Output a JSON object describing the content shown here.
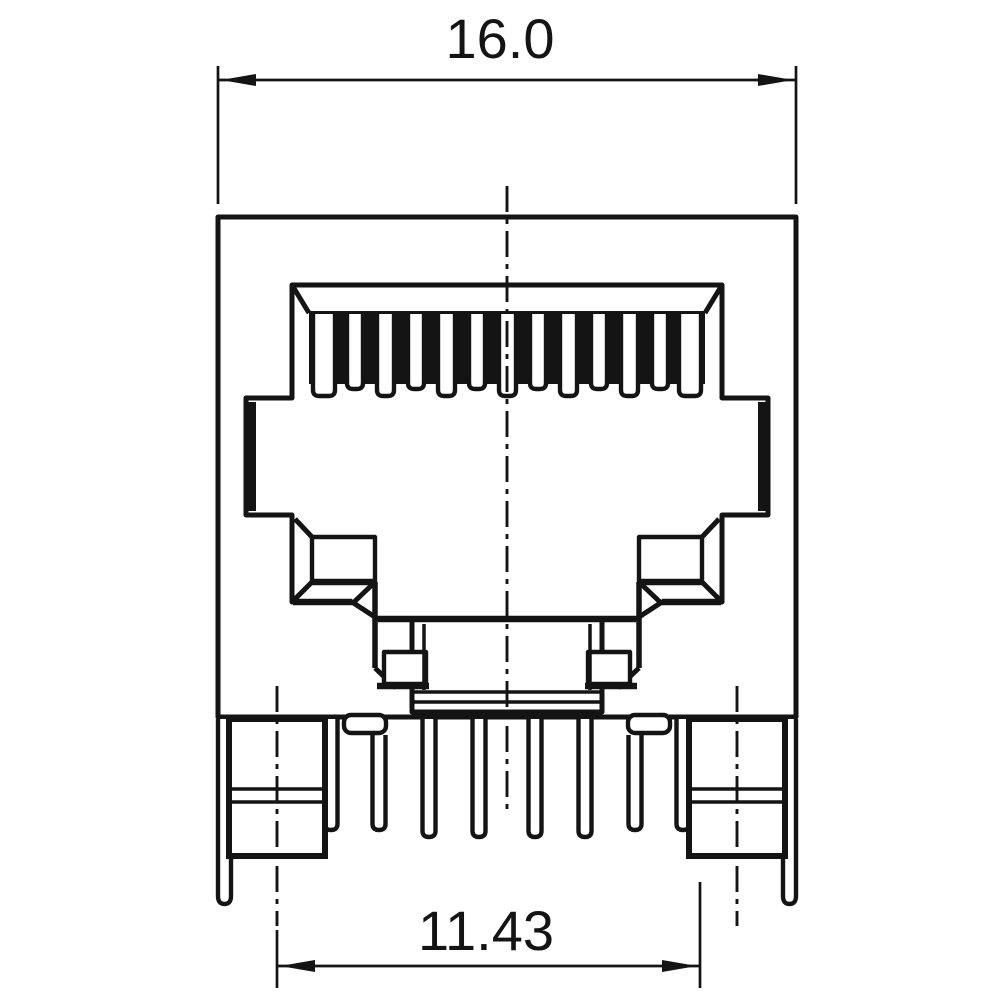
{
  "drawing": {
    "title": "RJ45 modular jack - front view technical drawing",
    "ink_color": "#141414",
    "paper_color": "#ffffff",
    "dimension_overall_width": {
      "label": "16.0"
    },
    "dimension_pin_row": {
      "label": "11.43"
    }
  }
}
